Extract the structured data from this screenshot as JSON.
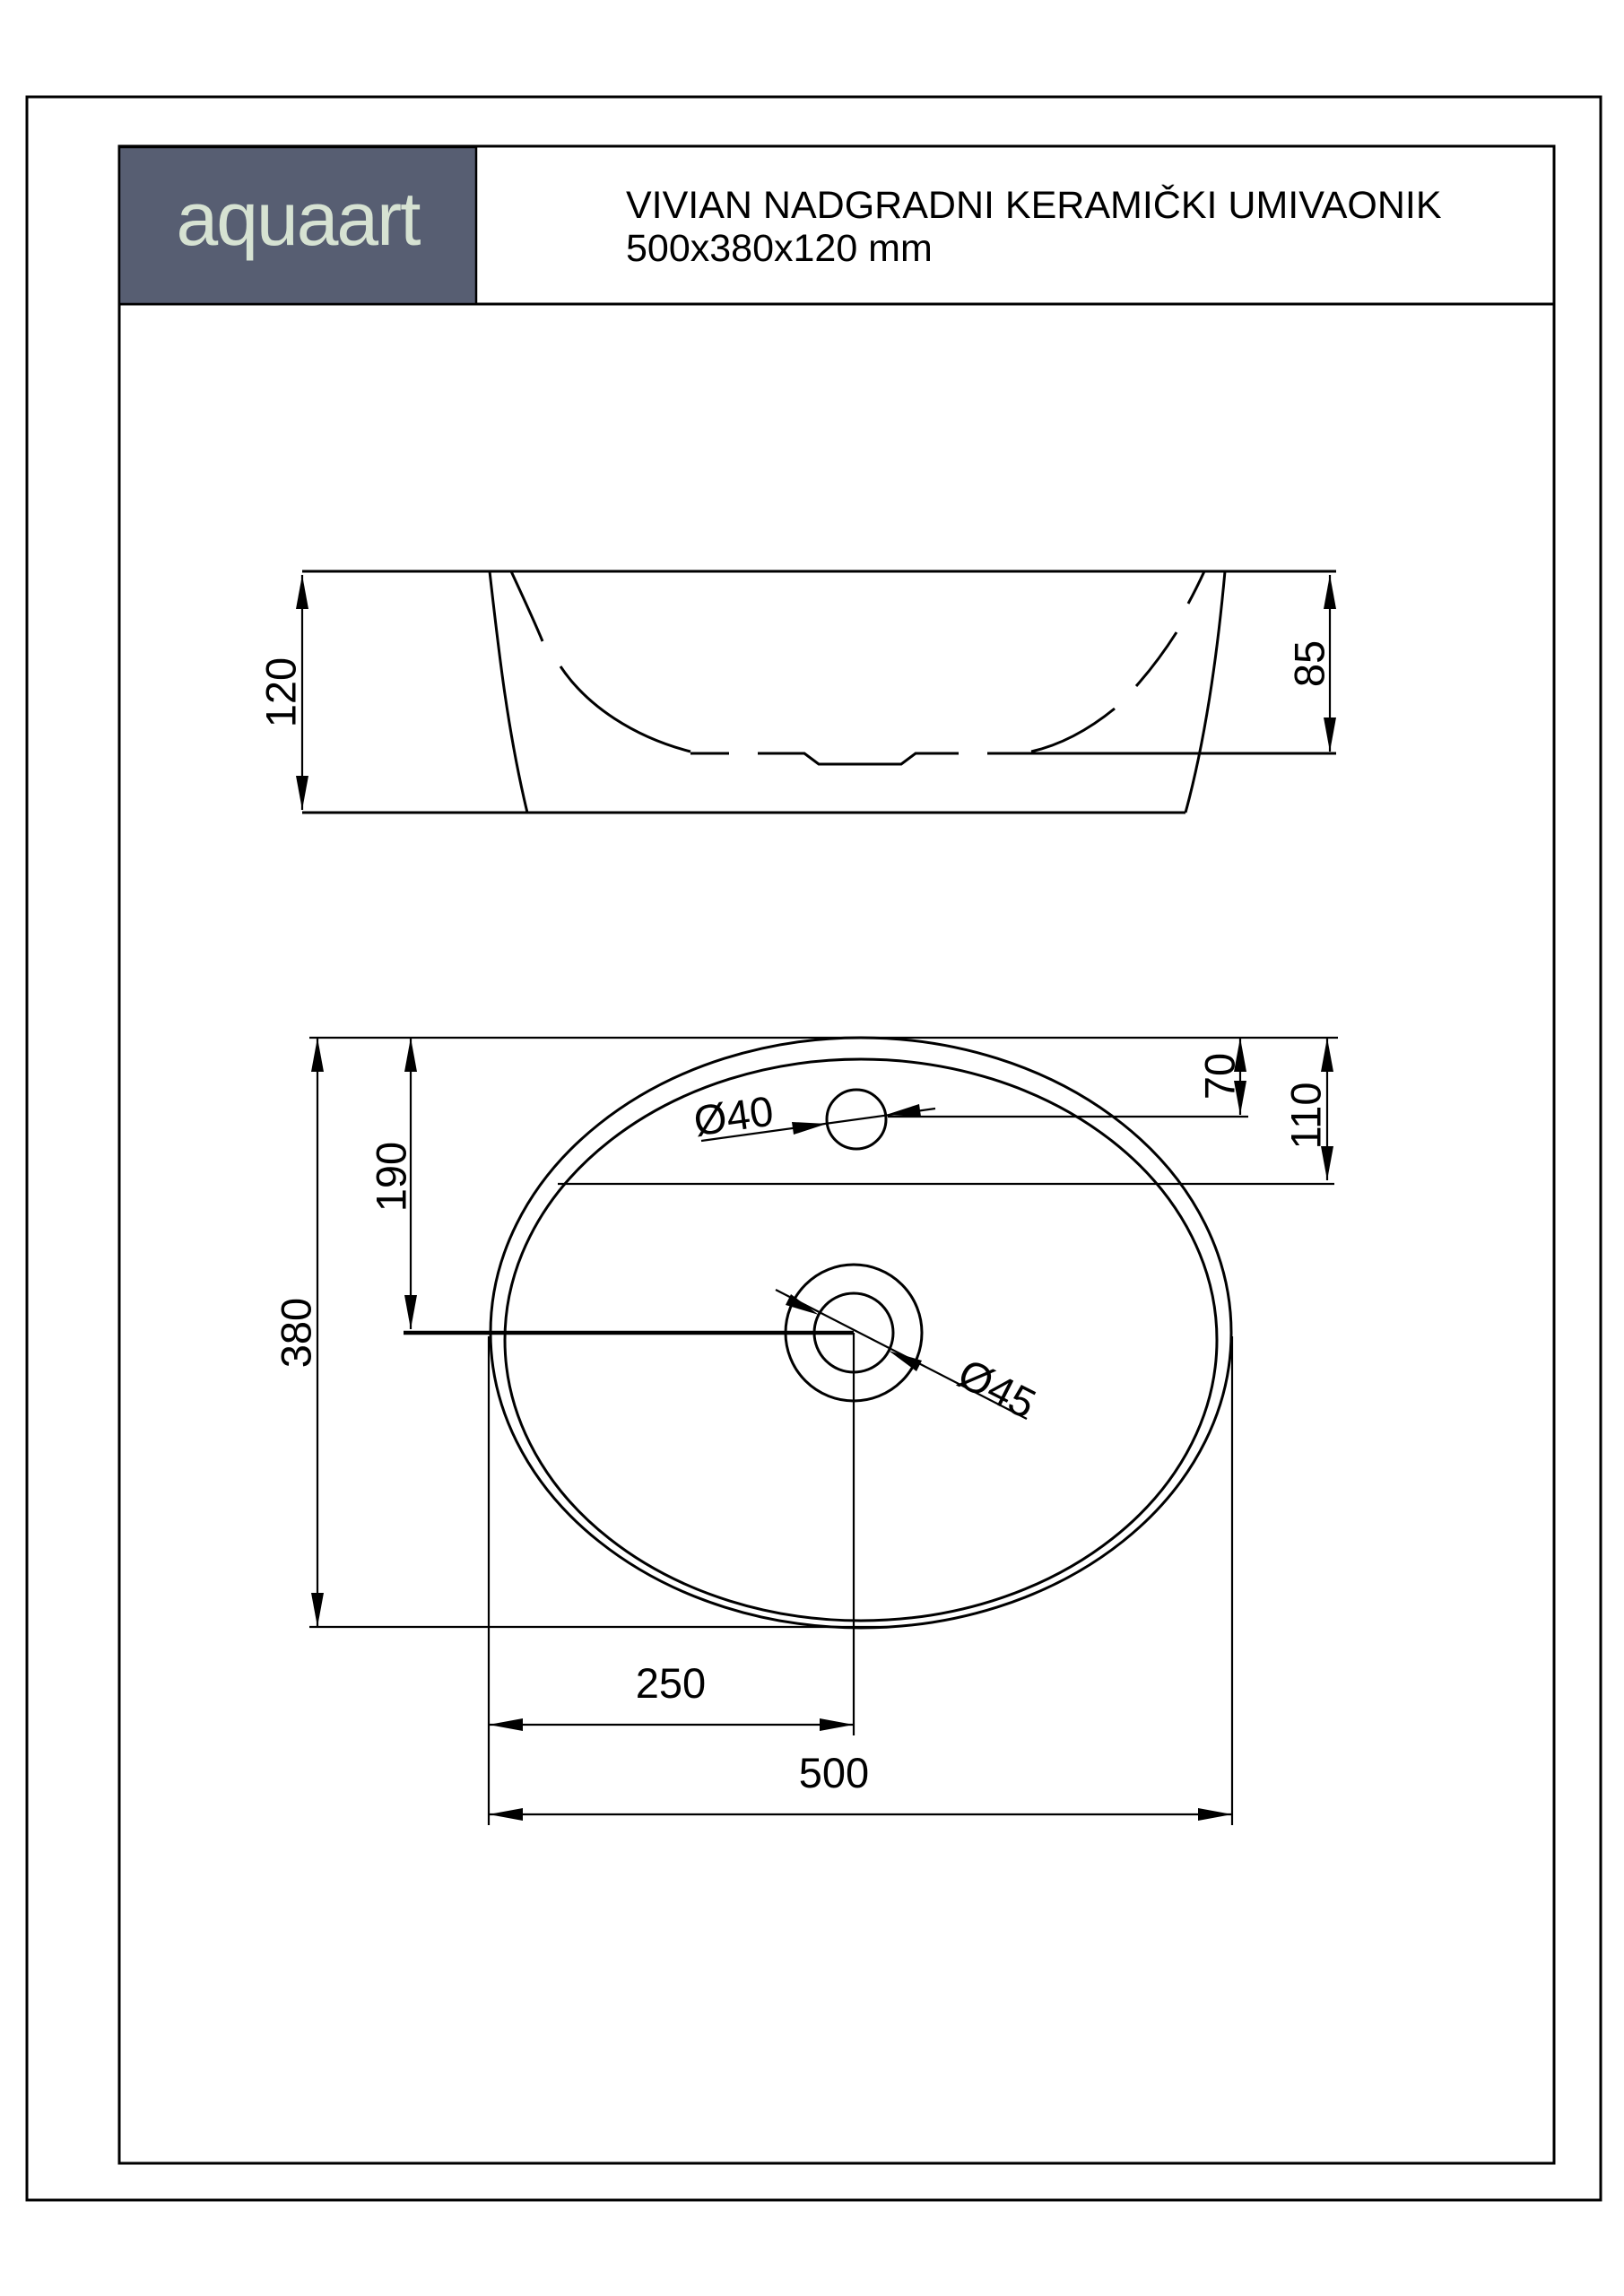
{
  "page": {
    "background": "#ffffff",
    "line_color": "#000000"
  },
  "header": {
    "brand": "aquaart",
    "logo_bg": "#575e72",
    "logo_text_color": "#d6e2d2",
    "title": "VIVIAN NADGRADNI KERAMIČKI UMIVAONIK",
    "subtitle": "500x380x120 mm"
  },
  "side_view": {
    "overall_height_label": "120",
    "inner_depth_label": "85"
  },
  "plan_view": {
    "overall_depth_label": "380",
    "drain_offset_label": "190",
    "faucet_hole_diameter_label": "Ø40",
    "faucet_offset_label": "70",
    "faucet_line_offset_label": "110",
    "drain_diameter_label": "Ø45",
    "drain_center_from_left_label": "250",
    "overall_width_label": "500"
  }
}
